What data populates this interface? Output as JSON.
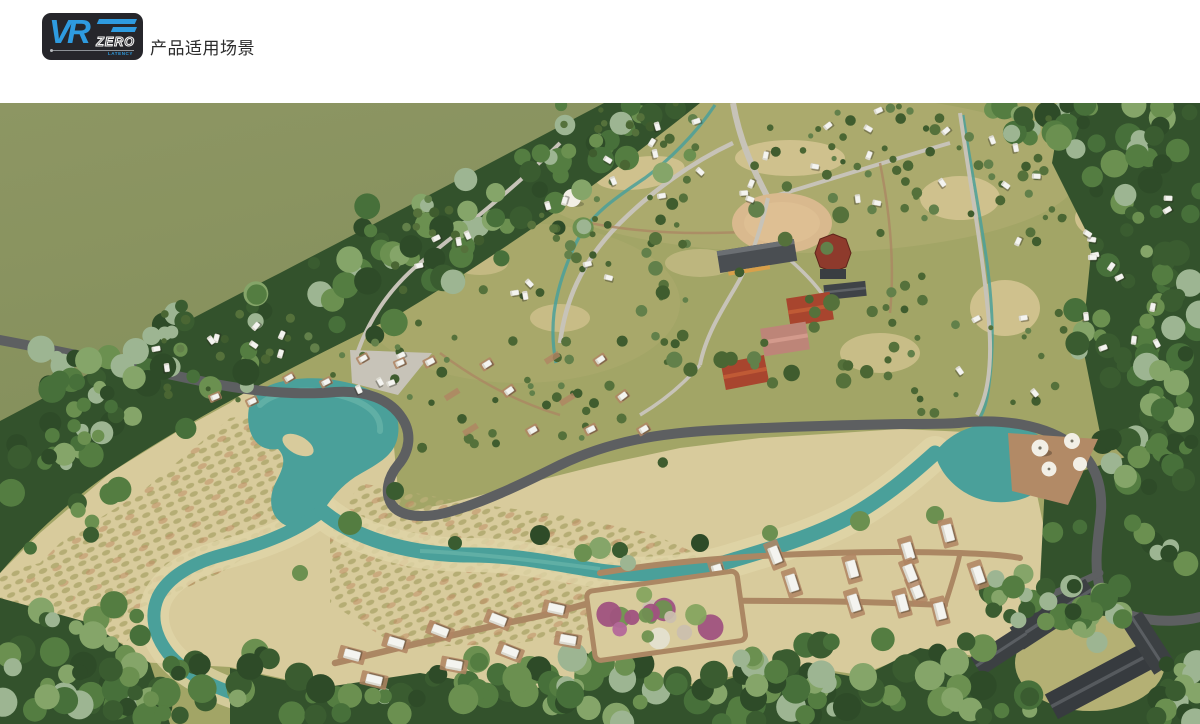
{
  "header": {
    "title": "产品适用场景",
    "logo": {
      "vr": "VR",
      "zero": "ZERO",
      "latency": "LATENCY"
    }
  },
  "scene": {
    "alt": "房车度假营地鸟瞰效果图：树林、草地、溪流湖泊、环形道路、房车营位、度假建筑与花园"
  },
  "palette": {
    "logo_bg": "#26262b",
    "logo_blue": "#2e9be0",
    "title_color": "#2b2b2b",
    "field_olive": "#8d9663",
    "field_olive_dark": "#85905c",
    "camp_base": "#a2a566",
    "camp_light": "#b4b074",
    "tan_patch": "#cfc18d",
    "sand": "#d8cb9c",
    "sand_light": "#e0d5a8",
    "shrub": "#b5ad74",
    "shrub_accent": "#bf8d66",
    "water": "#4aa09a",
    "water_light": "#6ab5aa",
    "road": "#5d5f61",
    "path_light": "#c7c3b8",
    "dirt": "#ab8763",
    "pad_brown": "#b08563",
    "rv_white": "#f4f4f0",
    "forest_dark": "#33522c",
    "plaza_tan": "#d9b98e",
    "roof_red": "#a8452e",
    "roof_red_light": "#c05a35",
    "roof_pink": "#bd8578",
    "roof_dark": "#4a4e52",
    "lodge_roof": "#3c4043",
    "deck_brown": "#b28a66",
    "umbrella_white": "#f2efe6",
    "forest_tones": [
      "#2e4b28",
      "#3a5c30",
      "#47703a",
      "#547d41",
      "#6b9050",
      "#85a569",
      "#9db592"
    ],
    "camp_tree_tones": [
      "#4a6633",
      "#55713b",
      "#62804a",
      "#3f5c2e"
    ],
    "garden_tones": [
      "#dcd8c6",
      "#cbbfae",
      "#b4679a",
      "#a0527f",
      "#86a45f",
      "#6f9150",
      "#e4e0d0"
    ]
  }
}
